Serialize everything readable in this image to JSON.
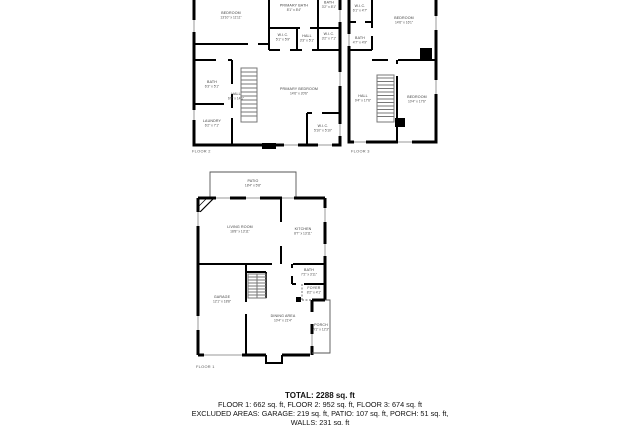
{
  "floors": [
    {
      "label": "FLOOR 2",
      "rooms": [
        {
          "name": "BEDROOM",
          "dims": "13'10\" x 11'11\""
        },
        {
          "name": "PRIMARY BATH",
          "dims": "8'1\" x 8'4\""
        },
        {
          "name": "BATH",
          "dims": "3'2\" x 8'1\""
        },
        {
          "name": "W.I.C.",
          "dims": "5'1\" x 5'9\""
        },
        {
          "name": "HALL",
          "dims": "3'3\" x 5'1\""
        },
        {
          "name": "W.I.C.",
          "dims": "3'2\" x 7'1\""
        },
        {
          "name": "BATH",
          "dims": "6'3\" x 5'1\""
        },
        {
          "name": "HALL",
          "dims": "6'8\" x 14'1\""
        },
        {
          "name": "PRIMARY BEDROOM",
          "dims": "14'6\" x 20'6\""
        },
        {
          "name": "LAUNDRY",
          "dims": "6'2\" x 7'1\""
        },
        {
          "name": "W.I.C.",
          "dims": "5'10\" x 5'10\""
        }
      ]
    },
    {
      "label": "FLOOR 3",
      "rooms": [
        {
          "name": "W.I.C.",
          "dims": "6'1\" x 4'7\""
        },
        {
          "name": "BEDROOM",
          "dims": "14'6\" x 16'1\""
        },
        {
          "name": "BATH",
          "dims": "4'7\" x 4'9\""
        },
        {
          "name": "HALL",
          "dims": "9'4\" x 17'6\""
        },
        {
          "name": "BEDROOM",
          "dims": "10'4\" x 17'6\""
        }
      ]
    },
    {
      "label": "FLOOR 1",
      "rooms": [
        {
          "name": "PATIO",
          "dims": "18'4\" x 5'8\""
        },
        {
          "name": "LIVING ROOM",
          "dims": "18'8\" x 13'11\""
        },
        {
          "name": "KITCHEN",
          "dims": "8'7\" x 13'11\""
        },
        {
          "name": "BATH",
          "dims": "7'2\" x 3'11\""
        },
        {
          "name": "FOYER",
          "dims": "8'2\" x 4'1\""
        },
        {
          "name": "GARAGE",
          "dims": "12'1\" x 18'8\""
        },
        {
          "name": "DINING AREA",
          "dims": "10'4\" x 21'4\""
        },
        {
          "name": "PORCH",
          "dims": "4'1\" x 12'3\""
        }
      ]
    }
  ],
  "summary": {
    "total": "TOTAL: 2288 sq. ft",
    "floor_areas": "FLOOR 1: 662 sq. ft, FLOOR 2: 952 sq. ft, FLOOR 3: 674 sq. ft",
    "excluded_areas": "EXCLUDED AREAS: GARAGE: 219 sq. ft, PATIO: 107 sq. ft, PORCH: 51 sq. ft,",
    "excluded_areas_cont": "WALLS: 231 sq. ft"
  },
  "colors": {
    "walls": "#000000",
    "room_label": "#3a3a3a",
    "background": "#ffffff"
  }
}
